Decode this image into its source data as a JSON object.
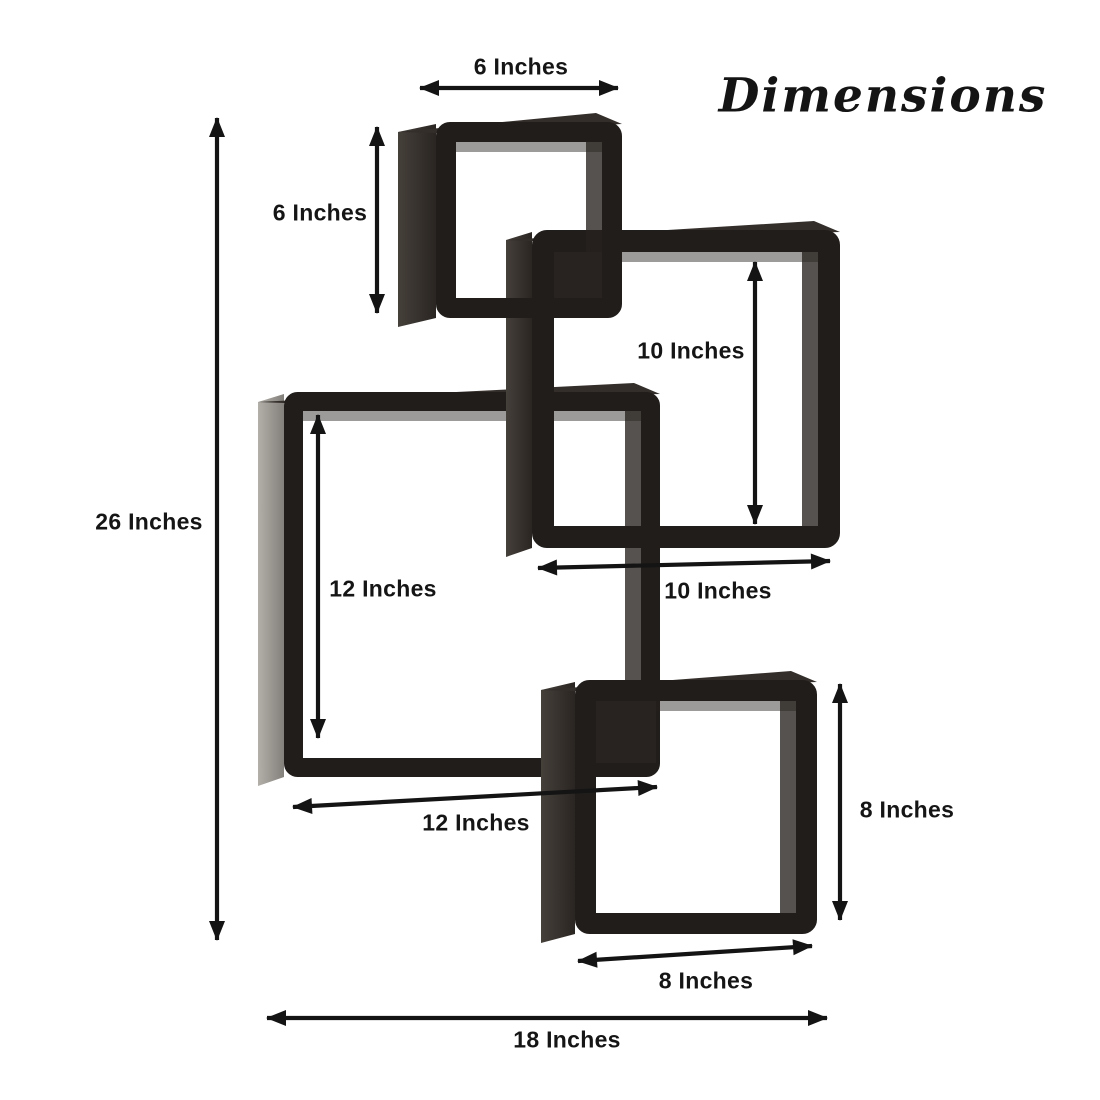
{
  "title": "Dimensions",
  "colors": {
    "background": "#ffffff",
    "frame": "#211d1b",
    "top_face": "#332e2a",
    "side_dark_a": "#45403a",
    "side_dark_b": "#2a2522",
    "side_light_a": "#b3afa9",
    "side_light_b": "#837f7a",
    "inner_wall": "rgba(38,33,29,0.78)",
    "inner_top": "rgba(38,33,29,0.45)",
    "cubby": "#282320",
    "arrow": "#141414",
    "label_text": "#151515"
  },
  "shelf_boxes": [
    {
      "name": "left-box-12x12",
      "size_inches": 12,
      "front": {
        "x": 284,
        "y": 392,
        "w": 376,
        "h": 385
      },
      "thickness": 19,
      "side_w": 26,
      "side_tone": "light"
    },
    {
      "name": "upper-right-box-10x10",
      "size_inches": 10,
      "front": {
        "x": 532,
        "y": 230,
        "w": 308,
        "h": 318
      },
      "thickness": 22,
      "side_w": 26,
      "side_tone": "dark"
    },
    {
      "name": "top-box-6x6",
      "size_inches": 6,
      "front": {
        "x": 436,
        "y": 122,
        "w": 186,
        "h": 196
      },
      "thickness": 20,
      "side_w": 38,
      "side_tone": "dark"
    },
    {
      "name": "bottom-box-8x8",
      "size_inches": 8,
      "front": {
        "x": 575,
        "y": 680,
        "w": 242,
        "h": 254
      },
      "thickness": 21,
      "side_w": 34,
      "side_tone": "dark"
    }
  ],
  "intersection_shadows": [
    {
      "x": 554,
      "y": 252,
      "w": 48,
      "h": 46
    },
    {
      "x": 596,
      "y": 701,
      "w": 60,
      "h": 62
    }
  ],
  "dimensions": [
    {
      "name": "top-box-width-6",
      "label": "6 Inches",
      "x1": 420,
      "y1": 88,
      "x2": 618,
      "y2": 88,
      "label_x": 521,
      "label_y": 67
    },
    {
      "name": "top-box-height-6",
      "label": "6 Inches",
      "x1": 377,
      "y1": 127,
      "x2": 377,
      "y2": 313,
      "label_x": 320,
      "label_y": 213
    },
    {
      "name": "right-box-height-10",
      "label": "10 Inches",
      "x1": 755,
      "y1": 262,
      "x2": 755,
      "y2": 524,
      "label_x": 691,
      "label_y": 351
    },
    {
      "name": "right-box-width-10",
      "label": "10 Inches",
      "x1": 538,
      "y1": 568,
      "x2": 830,
      "y2": 561,
      "label_x": 718,
      "label_y": 591
    },
    {
      "name": "left-box-height-12",
      "label": "12 Inches",
      "x1": 318,
      "y1": 415,
      "x2": 318,
      "y2": 738,
      "label_x": 383,
      "label_y": 589
    },
    {
      "name": "left-box-width-12",
      "label": "12 Inches",
      "x1": 293,
      "y1": 807,
      "x2": 657,
      "y2": 787,
      "label_x": 476,
      "label_y": 823
    },
    {
      "name": "bottom-box-height-8",
      "label": "8 Inches",
      "x1": 840,
      "y1": 684,
      "x2": 840,
      "y2": 920,
      "label_x": 907,
      "label_y": 810
    },
    {
      "name": "bottom-box-width-8",
      "label": "8 Inches",
      "x1": 578,
      "y1": 961,
      "x2": 812,
      "y2": 946,
      "label_x": 706,
      "label_y": 981
    },
    {
      "name": "total-height-26",
      "label": "26 Inches",
      "x1": 217,
      "y1": 118,
      "x2": 217,
      "y2": 940,
      "label_x": 149,
      "label_y": 522
    },
    {
      "name": "total-width-18",
      "label": "18 Inches",
      "x1": 267,
      "y1": 1018,
      "x2": 827,
      "y2": 1018,
      "label_x": 567,
      "label_y": 1040
    }
  ]
}
